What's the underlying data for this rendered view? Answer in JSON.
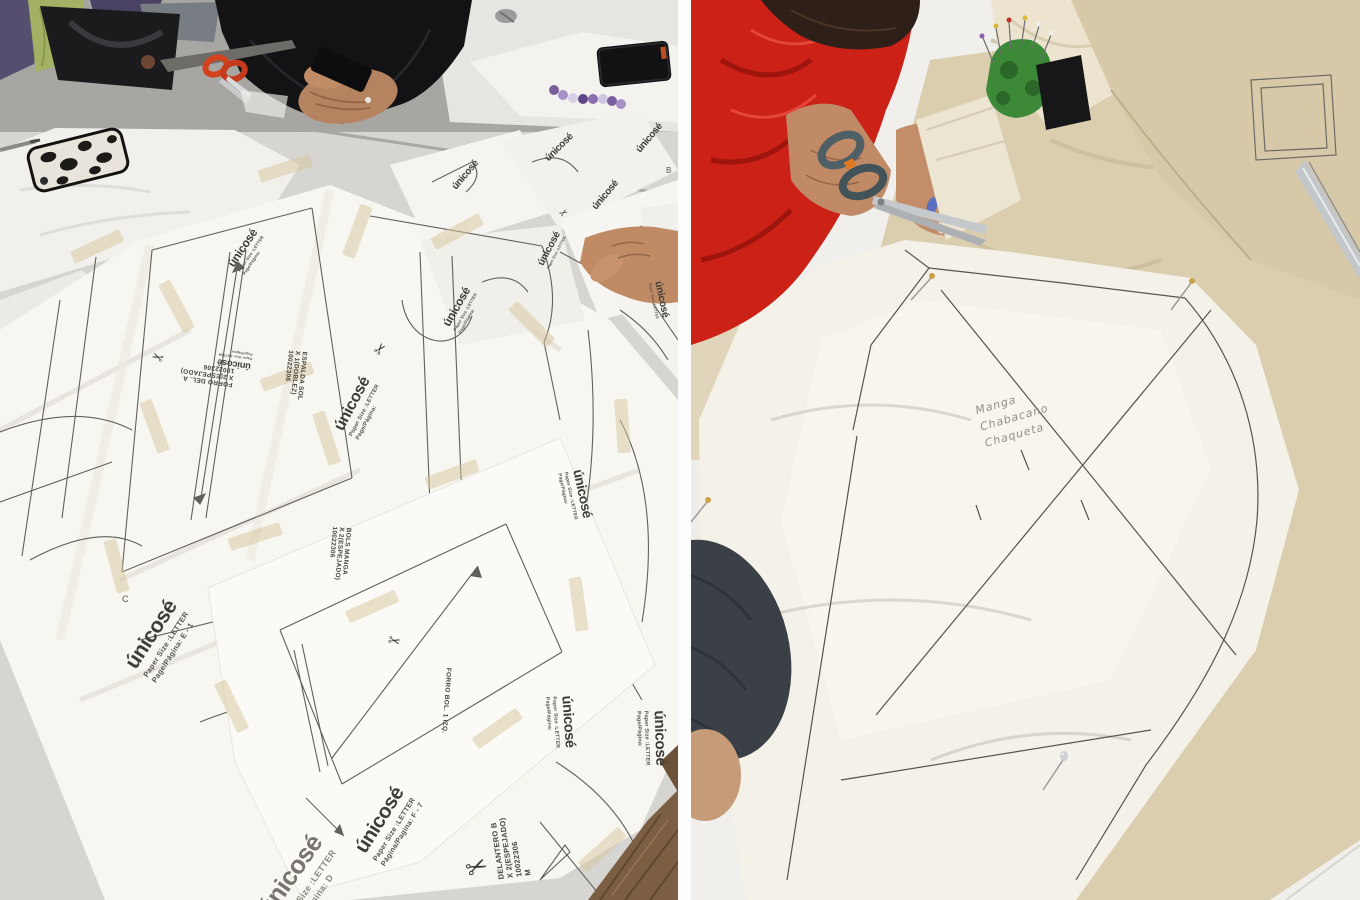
{
  "brand": {
    "name": "únicosé",
    "paper_size": "Paper Size :LETTER",
    "page_generic": "Page/Página:",
    "page_e1": "Page/Página: E - 1",
    "page_f7": "Página/Pagina: F - 7",
    "page_d": "Page/Página: D"
  },
  "labels": {
    "espalda": {
      "l1": "ESPALDA SOL",
      "l2": "X 1(DOBLEZ)",
      "l3": "10022306"
    },
    "forro_del": {
      "l1": "FORRO DEL. A",
      "l2": "X 2(ESPEJADO)",
      "l3": "10022306"
    },
    "bols_manga": {
      "l1": "BOLS MANGA",
      "l2": "X 2(ESPEJADO)",
      "l3": "10022306"
    },
    "forro_bol": {
      "l1": "FORRO BOL.  1 IZQ."
    },
    "delantero": {
      "l1": "DELANTERO B",
      "l2": "X 2(ESPEJADO)",
      "l3": "10022306",
      "l4": "M"
    }
  },
  "letters": {
    "c": "C",
    "b": "B"
  },
  "handwriting": {
    "l1": "Manga",
    "l2": "Chabacano",
    "l3": "Chaqueta"
  },
  "glyphs": {
    "scissors": "✂"
  },
  "colors": {
    "scissors_red": "#d2421f",
    "hoodie_red": "#cb2117",
    "pincushion_green": "#3c8a38",
    "muslin": "#dbceae",
    "bracelet_purple": "#8a6fb0"
  }
}
